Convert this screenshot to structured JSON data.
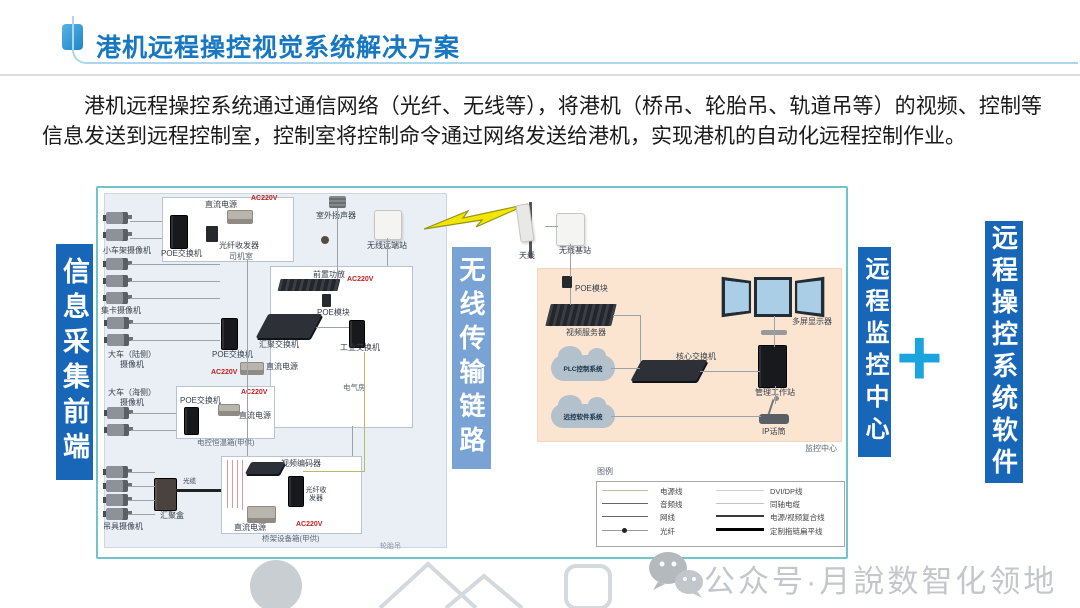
{
  "header": {
    "title": "港机远程操控视觉系统解决方案"
  },
  "intro": {
    "text": "港机远程操控系统通过通信网络（光纤、无线等），将港机（桥吊、轮胎吊、轨道吊等）的视频、控制等信息发送到远程控制室，控制室将控制命令通过网络发送给港机，实现港机的自动化远程控制作业。"
  },
  "banners": {
    "front_end": "信息采集前端",
    "wireless_link": "无线传输链路",
    "monitoring_center": "远程监控中心",
    "plus": "+",
    "control_software": "远程操控系统软件"
  },
  "field": {
    "trolley_cameras": "小车架摄像机",
    "cab_room": "司机室",
    "poe_switch": "POE交换机",
    "fiber_transceiver": "光纤收发器",
    "dc_power": "直流电源",
    "ac220v": "AC220V",
    "truck_cameras": "集卡摄像机",
    "gantry_land_cameras": "大车（陆侧）摄像机",
    "gantry_sea_cameras": "大车（海侧）摄像机",
    "aggregation_switch": "汇聚交换机",
    "industrial_switch": "工业交换机",
    "preamp": "前置功放",
    "poe_module": "POE模块",
    "outdoor_speaker": "室外扬声器",
    "wireless_remote_station": "无线远端站",
    "electrical_room": "电气房",
    "elec_control_box": "电控恒温箱(甲供)",
    "spreader_cameras": "吊具摄像机",
    "aggregation_box": "汇聚盒",
    "fiber_cable": "光缆",
    "video_encoder": "视频编码器",
    "crane_equipment_box": "桥架设备箱(甲供)",
    "area_tag": "轮胎吊"
  },
  "wireless": {
    "antenna": "天线",
    "base_station": "无线基站"
  },
  "center": {
    "poe_module": "POE模块",
    "video_server": "视频服务器",
    "plc_system_cloud": "PLC控制系统",
    "software_cloud": "远控软件系统",
    "core_switch": "核心交换机",
    "management_workstation": "管理工作站",
    "ip_mic": "IP话筒",
    "multi_display": "多屏显示器",
    "room_tag": "监控中心"
  },
  "legend": {
    "title": "图例",
    "left_items": [
      {
        "label": "电源线"
      },
      {
        "label": "音频线"
      },
      {
        "label": "网线"
      },
      {
        "label": "光纤"
      }
    ],
    "right_items": [
      {
        "label": "DVI/DP线"
      },
      {
        "label": "同轴电缆"
      },
      {
        "label": "电源/视频复合线"
      },
      {
        "label": "定制拖链扁平线"
      }
    ]
  },
  "footer": {
    "watermark": "公众号·月說数智化领地"
  },
  "colors": {
    "title_blue": "#1777c1",
    "banner_blue": "#1766b8",
    "banner_light_blue": "#79a3d4",
    "plus_cyan": "#1ba4de",
    "diagram_border_teal": "#6ec6cb",
    "left_panel_bg": "#eaeff6",
    "monitor_room_bg": "#fbe5d1",
    "ac_label_red": "#c22121",
    "lightning_yellow": "#f2e600"
  }
}
